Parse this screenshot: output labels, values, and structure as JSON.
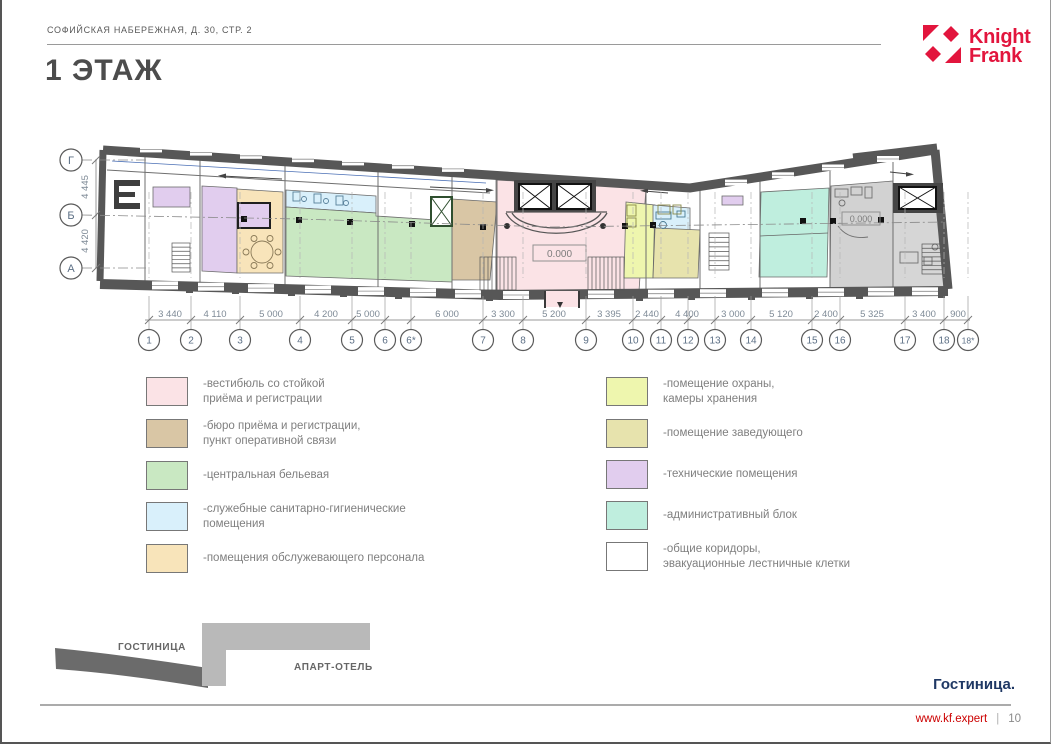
{
  "header": {
    "address": "СОФИЙСКАЯ НАБЕРЕЖНАЯ, Д. 30, СТР. 2"
  },
  "logo": {
    "name": "Knight Frank",
    "line1": "Knight",
    "line2": "Frank",
    "color": "#e2153d"
  },
  "title": "1 ЭТАЖ",
  "plan": {
    "level_mark": "0.000",
    "row_axes": [
      {
        "label": "Г",
        "x": 71,
        "y": 160
      },
      {
        "label": "Б",
        "x": 71,
        "y": 215,
        "long": true
      },
      {
        "label": "А",
        "x": 71,
        "y": 268
      }
    ],
    "v_dims": [
      {
        "label": "4 445",
        "y": 187
      },
      {
        "label": "4 420",
        "y": 241
      }
    ],
    "col_axes": [
      {
        "label": "1",
        "x": 149
      },
      {
        "label": "2",
        "x": 191
      },
      {
        "label": "3",
        "x": 240
      },
      {
        "label": "4",
        "x": 300
      },
      {
        "label": "5",
        "x": 352
      },
      {
        "label": "6",
        "x": 385
      },
      {
        "label": "6*",
        "x": 411
      },
      {
        "label": "7",
        "x": 483
      },
      {
        "label": "8",
        "x": 523
      },
      {
        "label": "9",
        "x": 586
      },
      {
        "label": "10",
        "x": 633
      },
      {
        "label": "11",
        "x": 661
      },
      {
        "label": "12",
        "x": 688
      },
      {
        "label": "13",
        "x": 715
      },
      {
        "label": "14",
        "x": 751
      },
      {
        "label": "15",
        "x": 812
      },
      {
        "label": "16",
        "x": 840
      },
      {
        "label": "17",
        "x": 905
      },
      {
        "label": "18",
        "x": 944
      },
      {
        "label": "18*",
        "x": 968
      }
    ],
    "h_dims": [
      {
        "label": "3 440",
        "x": 170
      },
      {
        "label": "4 110",
        "x": 215
      },
      {
        "label": "5 000",
        "x": 271
      },
      {
        "label": "4 200",
        "x": 326
      },
      {
        "label": "5 000",
        "x": 368
      },
      {
        "label": "6 000",
        "x": 447
      },
      {
        "label": "3 300",
        "x": 503
      },
      {
        "label": "5 200",
        "x": 554
      },
      {
        "label": "3 395",
        "x": 609
      },
      {
        "label": "2 440",
        "x": 647
      },
      {
        "label": "4 400",
        "x": 687
      },
      {
        "label": "3 000",
        "x": 733
      },
      {
        "label": "5 120",
        "x": 781
      },
      {
        "label": "2 400",
        "x": 826
      },
      {
        "label": "5 325",
        "x": 872
      },
      {
        "label": "3 400",
        "x": 924
      },
      {
        "label": "900",
        "x": 958
      }
    ]
  },
  "legend": {
    "left": [
      {
        "color": "#fbe3e6",
        "label": "-вестибюль со стойкой\nприёма и регистрации"
      },
      {
        "color": "#d9c6a5",
        "label": "-бюро приёма и регистрации,\nпункт оперативной связи"
      },
      {
        "color": "#c9e8c2",
        "label": "-центральная бельевая"
      },
      {
        "color": "#d9f0fb",
        "label": "-служебные санитарно-гигиенические\nпомещения"
      },
      {
        "color": "#f8e4ba",
        "label": "-помещения обслужевающего персонала"
      }
    ],
    "right": [
      {
        "color": "#eef6ae",
        "label": "-помещение охраны,\nкамеры хранения"
      },
      {
        "color": "#e7e3ad",
        "label": "-помещение заведующего"
      },
      {
        "color": "#e1cdee",
        "label": "-технические помещения"
      },
      {
        "color": "#bfeede",
        "label": "-административный блок"
      },
      {
        "color": "#ffffff",
        "label": "-общие коридоры,\nэвакуационные лестничные клетки"
      }
    ]
  },
  "site_diagram": {
    "hotel_label": "ГОСТИНИЦА",
    "apart_label": "АПАРТ-ОТЕЛЬ"
  },
  "footer": {
    "caption": "Гостиница.",
    "site": "www.kf.expert",
    "separator": "|",
    "page": "10"
  }
}
